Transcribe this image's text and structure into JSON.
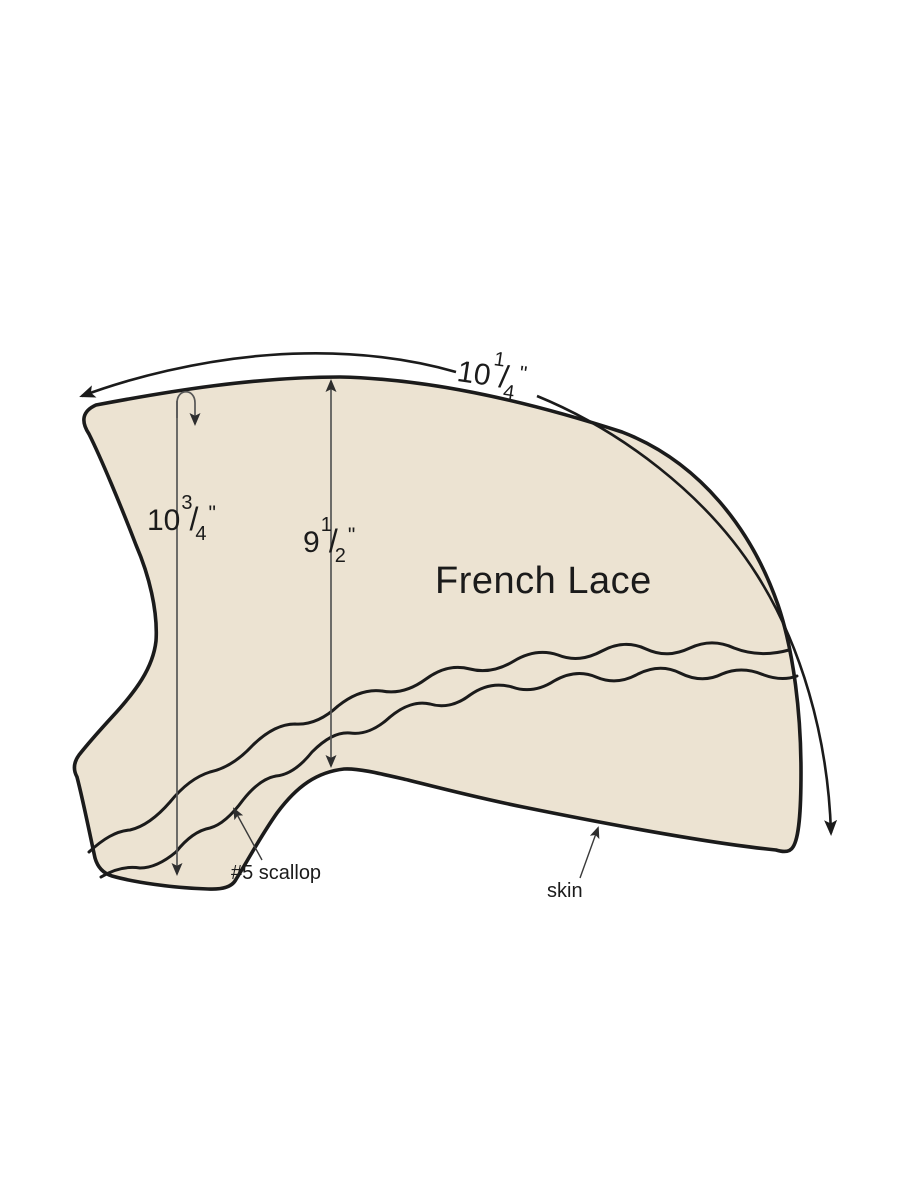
{
  "diagram": {
    "description": "hairpiece base pattern diagram",
    "background": "#ffffff",
    "shape_fill": "#ece3d2",
    "outline_color": "#1b1b1b",
    "measure_line_color": "#565656",
    "leader_line_color": "#3a3a3a",
    "labels": {
      "material": "French Lace",
      "scallop": "#5 scallop",
      "skin": "skin"
    },
    "fraction_slash": "/",
    "measurements": {
      "outer_arc": {
        "whole": "10",
        "numerator": "1",
        "denominator": "4",
        "unit": "\""
      },
      "left_depth": {
        "whole": "10",
        "numerator": "3",
        "denominator": "4",
        "unit": "\""
      },
      "center_depth": {
        "whole": "9",
        "numerator": "1",
        "denominator": "2",
        "unit": "\""
      }
    }
  }
}
